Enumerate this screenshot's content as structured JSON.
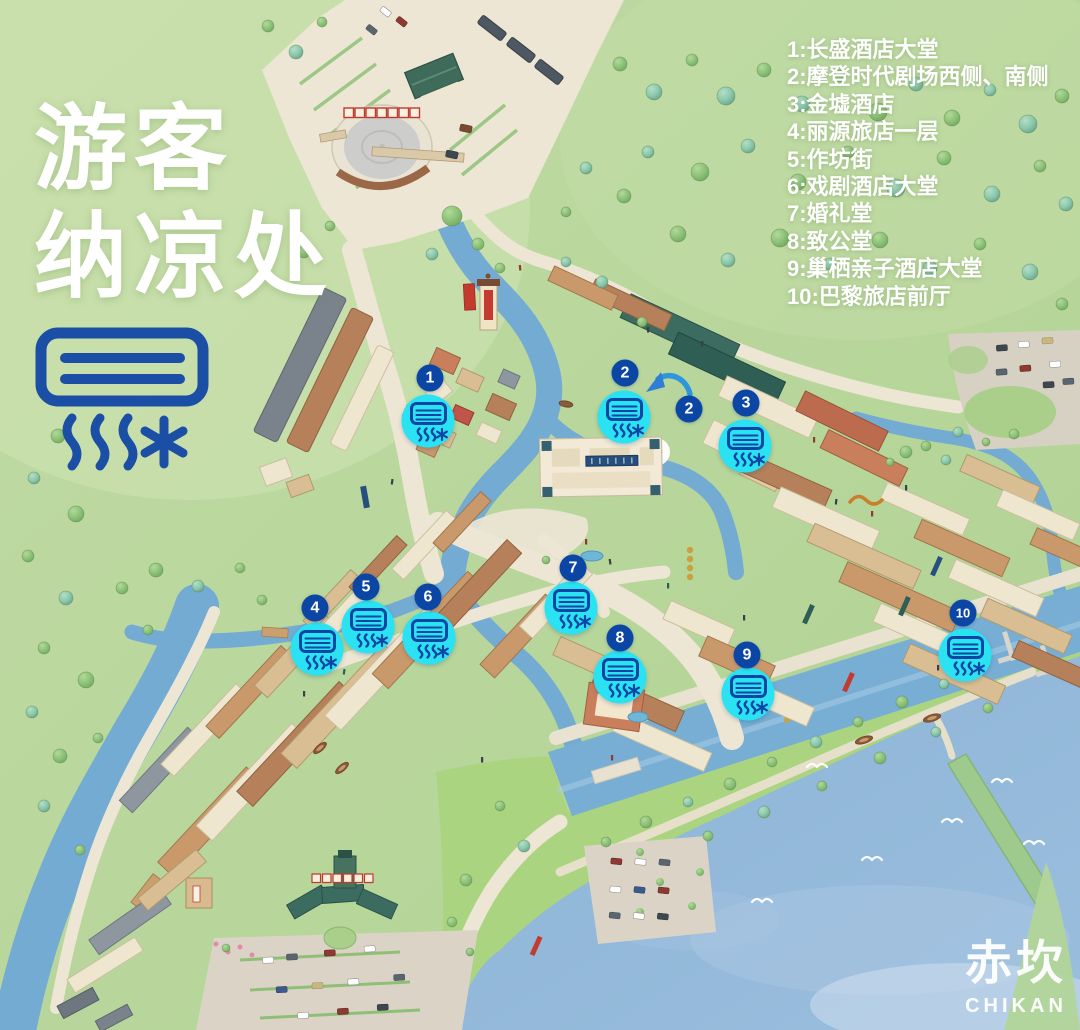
{
  "title": {
    "line1": "游客",
    "line2": "纳凉处"
  },
  "legend": {
    "items": [
      "1:长盛酒店大堂",
      "2:摩登时代剧场西侧、南侧",
      "3:金墟酒店",
      "4:丽源旅店一层",
      "5:作坊街",
      "6:戏剧酒店大堂",
      "7:婚礼堂",
      "8:致公堂",
      "9:巢栖亲子酒店大堂",
      "10:巴黎旅店前厅"
    ]
  },
  "markers": [
    {
      "num": "1",
      "x": 428,
      "y": 421,
      "bx": 430,
      "by": 378
    },
    {
      "num": "2",
      "x": 624,
      "y": 417,
      "bx": 625,
      "by": 373
    },
    {
      "num": "3",
      "x": 745,
      "y": 446,
      "bx": 746,
      "by": 403
    },
    {
      "num": "4",
      "x": 317,
      "y": 649,
      "bx": 315,
      "by": 608
    },
    {
      "num": "5",
      "x": 368,
      "y": 627,
      "bx": 366,
      "by": 587
    },
    {
      "num": "6",
      "x": 429,
      "y": 638,
      "bx": 428,
      "by": 597
    },
    {
      "num": "7",
      "x": 571,
      "y": 608,
      "bx": 573,
      "by": 568
    },
    {
      "num": "8",
      "x": 620,
      "y": 677,
      "bx": 620,
      "by": 638
    },
    {
      "num": "9",
      "x": 748,
      "y": 694,
      "bx": 747,
      "by": 655
    },
    {
      "num": "10",
      "x": 965,
      "y": 655,
      "bx": 963,
      "by": 613
    }
  ],
  "extra_badges": [
    {
      "num": "2",
      "x": 689,
      "y": 409
    }
  ],
  "logo": {
    "cn": "赤坎",
    "en": "CHIKAN"
  },
  "colors": {
    "marker_cyan": "#2BE2F2",
    "marker_badge_blue": "#0C46A5",
    "icon_blue": "#1B4FA5",
    "text_white": "#FFFFFF"
  }
}
